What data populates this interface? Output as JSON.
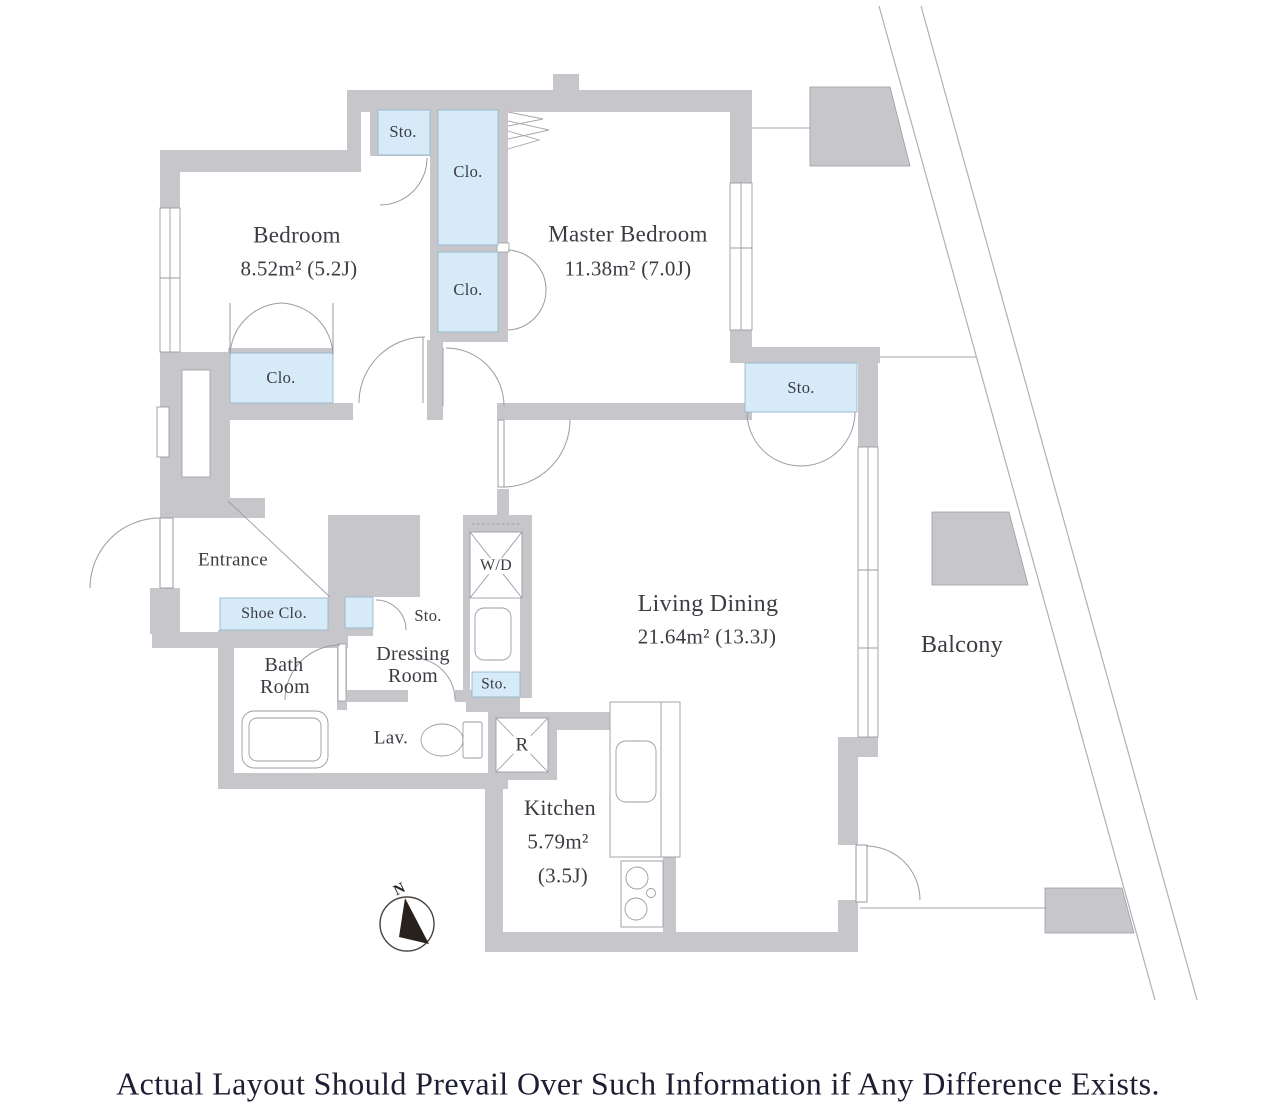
{
  "colors": {
    "wall_fill": "#c7c7cb",
    "line": "#9b9ba2",
    "storage_fill": "#d6ebf7",
    "storage_border": "#95b8cb",
    "label_text": "#3b3b42",
    "disclaimer_text": "#1d1d33",
    "site_boundary_line": "#b0b0b5",
    "compass_needle": "#29211c"
  },
  "floor_plan": {
    "rooms": {
      "bedroom": {
        "name": "Bedroom",
        "area": "8.52m² (5.2J)"
      },
      "master_bedroom": {
        "name": "Master Bedroom",
        "area": "11.38m² (7.0J)"
      },
      "living_dining": {
        "name": "Living Dining",
        "area": "21.64m² (13.3J)"
      },
      "kitchen": {
        "name": "Kitchen",
        "area": "5.79m²",
        "area_tatami": "(3.5J)"
      },
      "entrance": {
        "name": "Entrance"
      },
      "bath_room": {
        "name_line1": "Bath",
        "name_line2": "Room"
      },
      "dressing_room": {
        "name_line1": "Dressing",
        "name_line2": "Room"
      },
      "lavatory": {
        "name": "Lav."
      },
      "balcony": {
        "name": "Balcony"
      }
    },
    "storage": {
      "storage_abbr": "Sto.",
      "closet_abbr": "Clo.",
      "shoe_closet_abbr": "Shoe Clo."
    },
    "equipment": {
      "washer_dryer_abbr": "W/D",
      "refrigerator_abbr": "R"
    },
    "compass": {
      "north": "N"
    }
  },
  "footer": {
    "disclaimer": "Actual Layout Should Prevail Over Such Information if Any Difference Exists."
  }
}
